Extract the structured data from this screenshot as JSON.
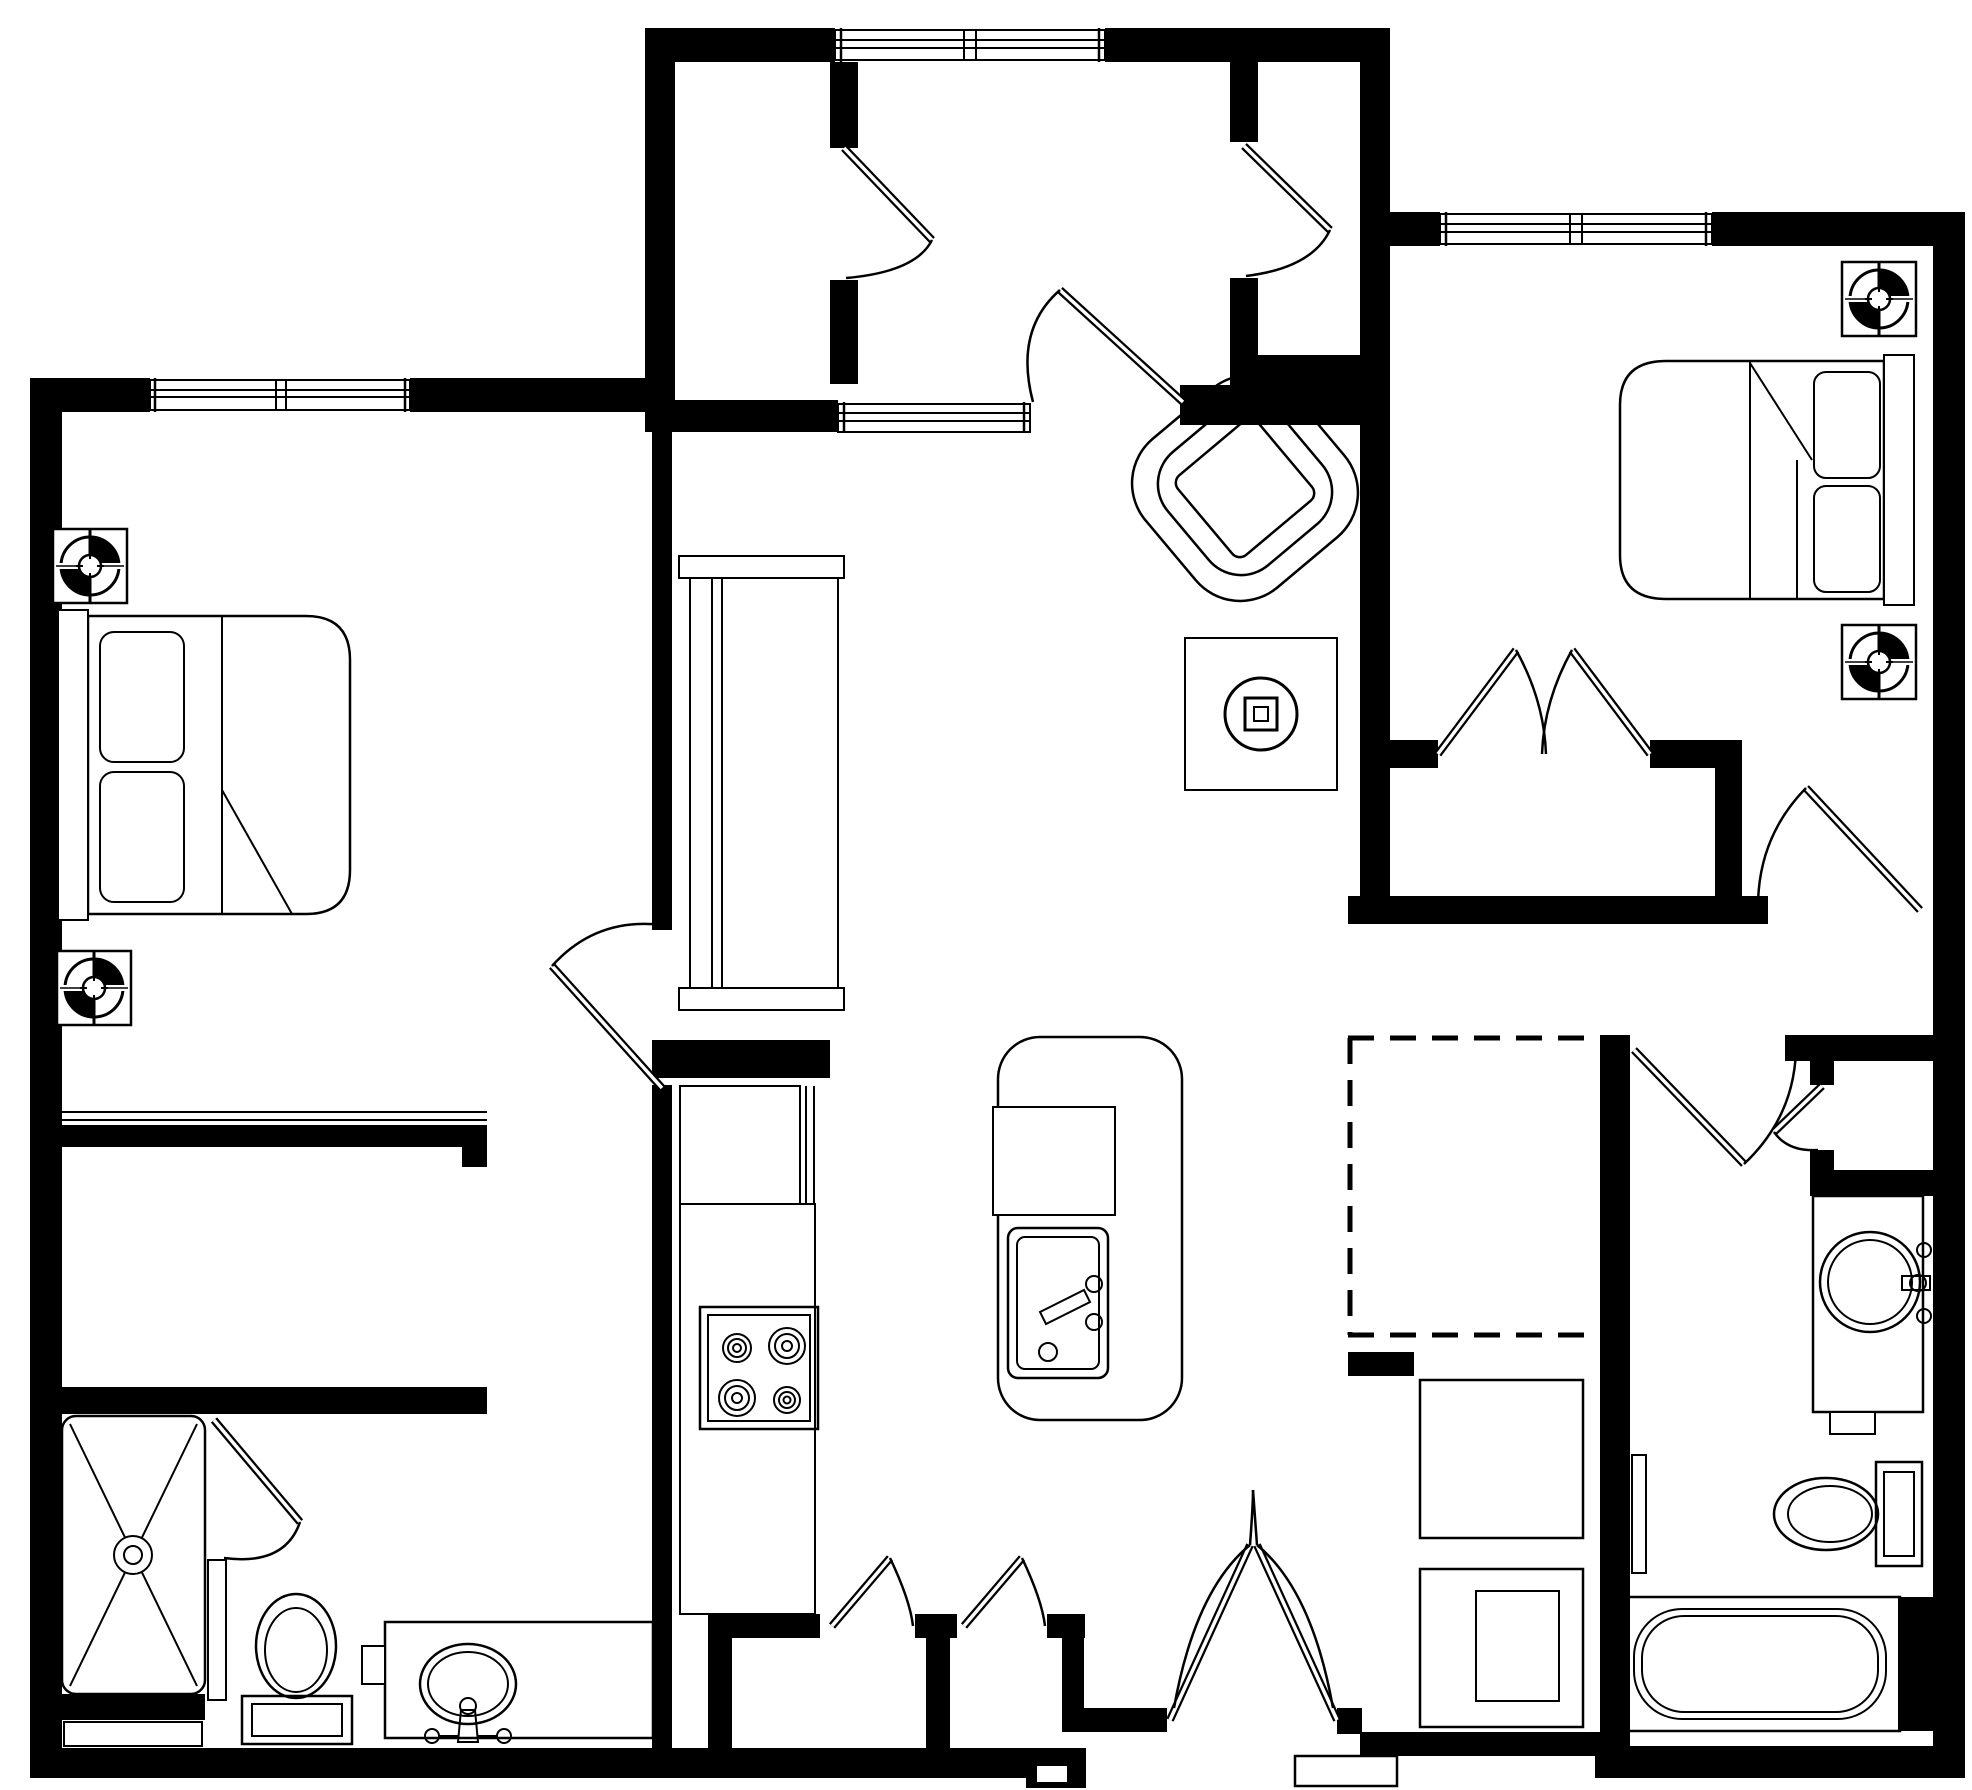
{
  "floor_plan": {
    "type": "apartment-floor-plan",
    "canvas": {
      "width": 1972,
      "height": 1790
    },
    "colors": {
      "background": "#ffffff",
      "walls": "#000000",
      "lines": "#000000"
    },
    "style": "black-and-white architectural line drawing, no text labels",
    "regions": [
      {
        "name": "bedroom-1",
        "position": "left",
        "fixtures": [
          "double-bed-head-left",
          "nightstand",
          "nightstand",
          "ceiling-fan-symbol",
          "ceiling-fan-symbol",
          "window-double",
          "closet-rod-wall",
          "swing-door"
        ]
      },
      {
        "name": "bathroom-1",
        "position": "bottom-left",
        "fixtures": [
          "shower-x-pan-with-drain",
          "shower-door",
          "half-wall-divider",
          "toilet",
          "vanity-counter-oval-sink-faucet",
          "wall-niche"
        ]
      },
      {
        "name": "entry-hall",
        "position": "top-center",
        "fixtures": [
          "closet-left-with-door",
          "closet-right-with-door",
          "window-double",
          "pass-through-window",
          "swing-door-to-living"
        ]
      },
      {
        "name": "living-dining",
        "position": "center",
        "fixtures": [
          "media-shelf-unit",
          "armchair-rotated",
          "end-table-with-lamp-symbol"
        ]
      },
      {
        "name": "kitchen",
        "position": "center-bottom",
        "fixtures": [
          "refrigerator",
          "counter-run",
          "range-4-burners",
          "island-rounded",
          "island-inset-square",
          "island-sink-with-faucet"
        ]
      },
      {
        "name": "bedroom-2",
        "position": "top-right",
        "fixtures": [
          "double-bed-head-right",
          "nightstand",
          "nightstand",
          "ceiling-fan-symbol",
          "ceiling-fan-symbol",
          "window-double",
          "double-door-closet",
          "swing-door"
        ]
      },
      {
        "name": "hallway",
        "position": "right-middle",
        "fixtures": [
          "swing-door-to-bathroom"
        ]
      },
      {
        "name": "optional-area",
        "position": "center-right",
        "fixtures": [
          "dashed-outline-rectangle"
        ]
      },
      {
        "name": "laundry-nook",
        "position": "bottom-right-center",
        "fixtures": [
          "washer",
          "dryer-with-inner-panel"
        ]
      },
      {
        "name": "bathroom-2",
        "position": "bottom-right",
        "fixtures": [
          "linen-closet-with-door",
          "vanity-counter-round-sink-faucet",
          "toilet",
          "bathtub",
          "towel-bar"
        ]
      },
      {
        "name": "entry-vestibule",
        "position": "bottom-center",
        "fixtures": [
          "double-entry-doors",
          "exterior-stoop",
          "storage-closet-a-with-door",
          "storage-closet-b-with-door"
        ]
      }
    ],
    "counts": {
      "windows": 4,
      "swing-doors": 11,
      "double-door-pairs": 2,
      "ceiling-fan-symbols": 4,
      "beds": 2,
      "toilets": 2,
      "sinks": 3,
      "bathtubs": 1,
      "showers": 1
    }
  }
}
